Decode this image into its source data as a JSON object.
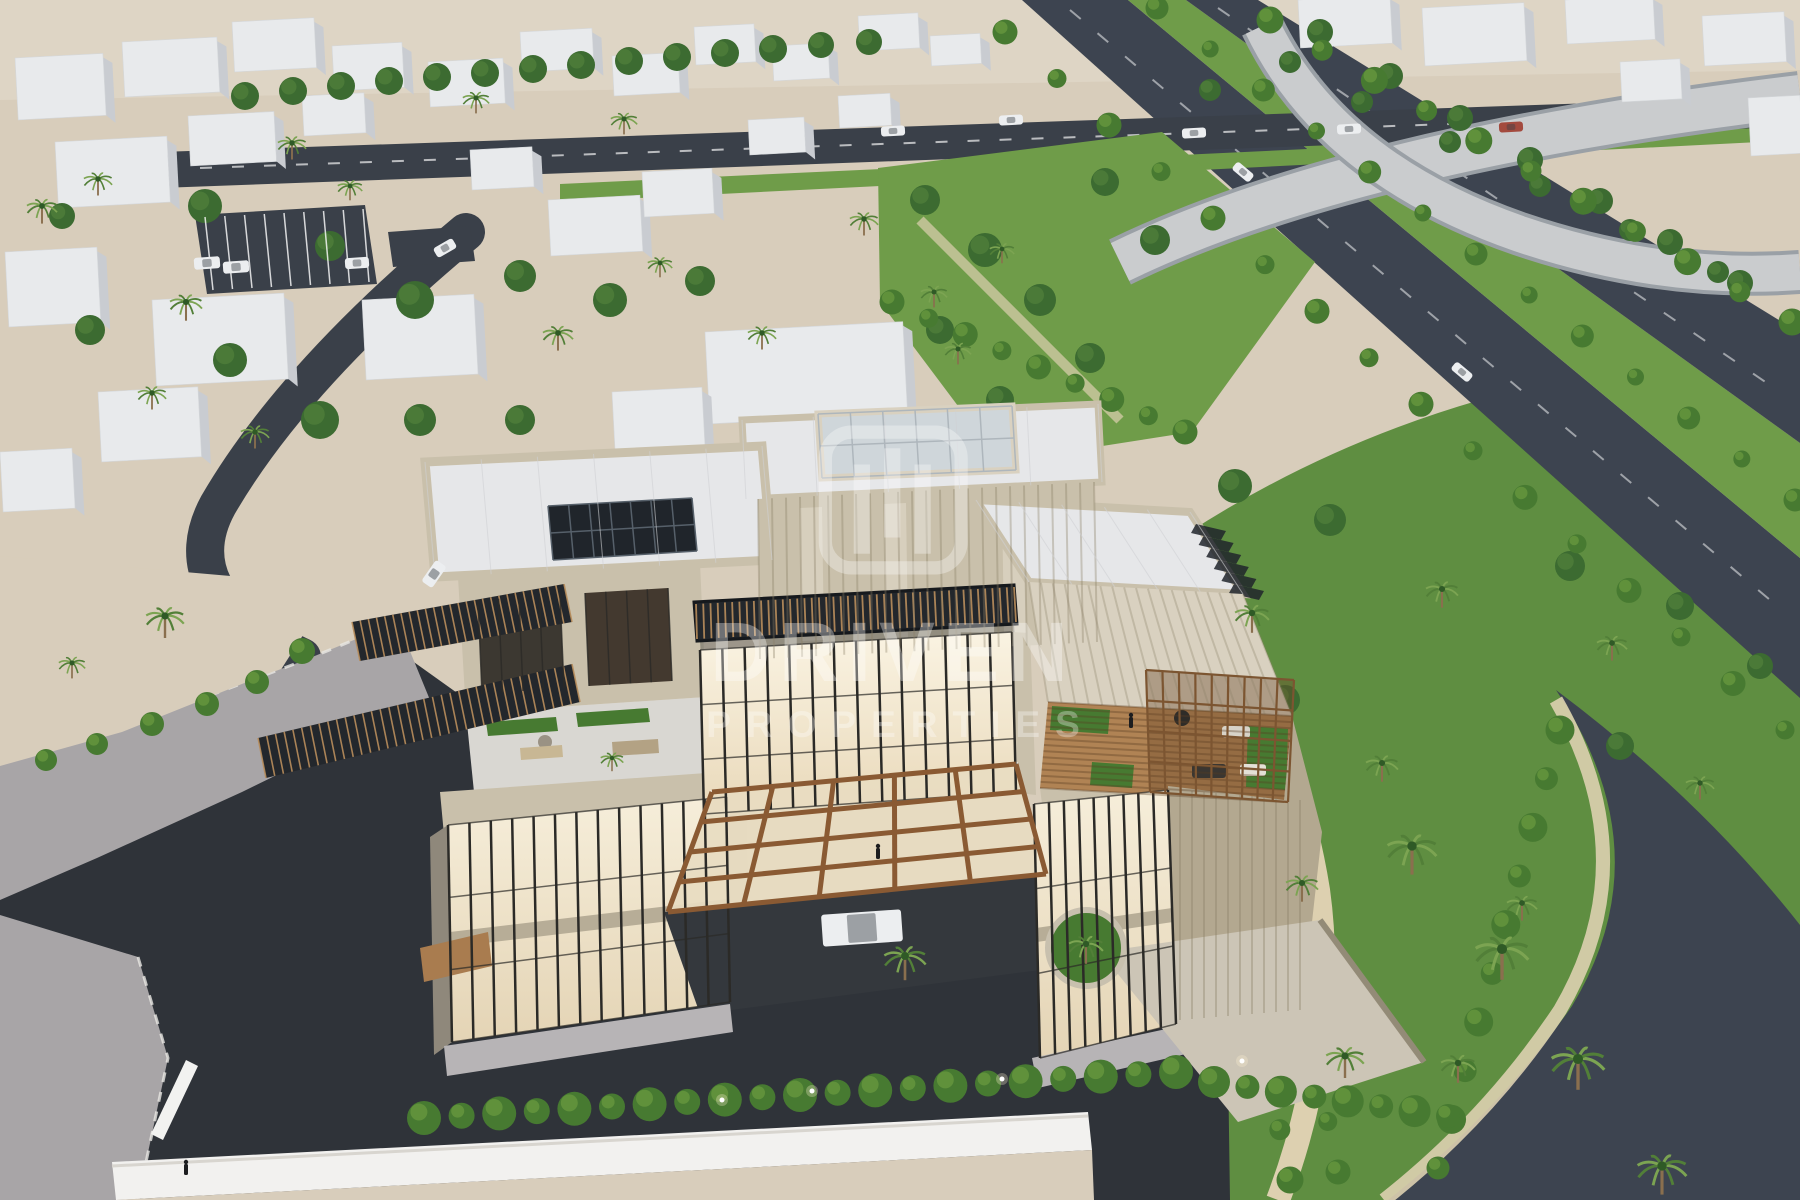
{
  "watermark": {
    "logo_icon": "driven-properties-logo",
    "brand": "DRIVEN",
    "brand_sub": "PROPERTIES",
    "color": "#ffffff",
    "opacity": 0.33
  },
  "palette": {
    "sand": "#d8cdbb",
    "sand2": "#e3dacb",
    "roadDark": "#2f3339",
    "roadMed": "#3a4049",
    "roadFwy": "#3d4450",
    "pave": "#a8a5a7",
    "paveL": "#b7b4b6",
    "lawn": "#5f8e41",
    "lawnL": "#6f9c49",
    "bush": "#477a31",
    "bushL": "#66973f",
    "tree": "#3c6b31",
    "treeL": "#4e7d39",
    "palm": "#527f38",
    "palmL": "#7ca452",
    "trunk": "#8a6f4e",
    "ctx": "#e8eaec",
    "ctxSide": "#c9ccd1",
    "stone": "#c9c0ab",
    "stoneL": "#d9d1c0",
    "stoneD": "#b3a890",
    "streak": "#8a7f66",
    "roof": "#e6e7e9",
    "roofLine": "#d0d1d4",
    "glassWarmA": "#f6eeda",
    "glassWarmB": "#e4d4b5",
    "sky": "#cfd6da",
    "mullion": "#2b2a27",
    "bronze": "#8a5a33",
    "wood": "#a97c4f",
    "deck": "#b08354",
    "louver": "#23272c",
    "slat": "#b98e5c",
    "solar": "#20252b",
    "solarLine": "#56606a",
    "wall": "#f2f1ef",
    "path": "#ddd0b0",
    "flyover": "#caccce",
    "flyoverEdge": "#9aa0a6",
    "carWhite": "#eceef0",
    "carRed": "#a34a3e",
    "figure": "#1c1d1f"
  },
  "scene": {
    "context_buildings": [
      [
        15,
        58,
        88,
        62
      ],
      [
        122,
        42,
        95,
        55
      ],
      [
        232,
        22,
        82,
        50
      ],
      [
        332,
        46,
        70,
        45
      ],
      [
        428,
        62,
        75,
        45
      ],
      [
        520,
        32,
        72,
        40
      ],
      [
        612,
        56,
        66,
        40
      ],
      [
        694,
        27,
        60,
        38
      ],
      [
        772,
        46,
        56,
        35
      ],
      [
        858,
        16,
        60,
        35
      ],
      [
        930,
        36,
        50,
        30
      ],
      [
        55,
        142,
        112,
        66
      ],
      [
        188,
        116,
        86,
        50
      ],
      [
        302,
        96,
        62,
        40
      ],
      [
        470,
        150,
        62,
        40
      ],
      [
        548,
        200,
        92,
        56
      ],
      [
        642,
        172,
        70,
        45
      ],
      [
        748,
        120,
        56,
        35
      ],
      [
        838,
        96,
        52,
        32
      ],
      [
        5,
        252,
        92,
        75
      ],
      [
        152,
        300,
        132,
        86
      ],
      [
        362,
        300,
        112,
        80
      ],
      [
        98,
        392,
        100,
        70
      ],
      [
        0,
        452,
        72,
        60
      ],
      [
        705,
        332,
        198,
        92
      ],
      [
        612,
        392,
        90,
        62
      ],
      [
        1298,
        0,
        92,
        48
      ],
      [
        1422,
        8,
        102,
        58
      ],
      [
        1565,
        0,
        88,
        44
      ],
      [
        1702,
        16,
        82,
        50
      ],
      [
        1748,
        98,
        52,
        58
      ],
      [
        1620,
        62,
        60,
        40
      ]
    ],
    "trees": [
      [
        245,
        96,
        14
      ],
      [
        293,
        91,
        14
      ],
      [
        341,
        86,
        14
      ],
      [
        389,
        81,
        14
      ],
      [
        437,
        77,
        14
      ],
      [
        485,
        73,
        14
      ],
      [
        533,
        69,
        14
      ],
      [
        581,
        65,
        14
      ],
      [
        629,
        61,
        14
      ],
      [
        677,
        57,
        14
      ],
      [
        725,
        53,
        14
      ],
      [
        773,
        49,
        14
      ],
      [
        821,
        45,
        13
      ],
      [
        869,
        42,
        13
      ],
      [
        205,
        206,
        17
      ],
      [
        330,
        246,
        15
      ],
      [
        415,
        300,
        19
      ],
      [
        520,
        276,
        16
      ],
      [
        610,
        300,
        17
      ],
      [
        700,
        281,
        15
      ],
      [
        230,
        360,
        17
      ],
      [
        320,
        420,
        19
      ],
      [
        420,
        420,
        16
      ],
      [
        520,
        420,
        15
      ],
      [
        90,
        330,
        15
      ],
      [
        62,
        216,
        13
      ],
      [
        925,
        200,
        15
      ],
      [
        985,
        250,
        17
      ],
      [
        1040,
        300,
        16
      ],
      [
        1090,
        358,
        15
      ],
      [
        1000,
        400,
        14
      ],
      [
        940,
        330,
        14
      ],
      [
        1105,
        182,
        14
      ],
      [
        1155,
        240,
        15
      ],
      [
        1235,
        486,
        17
      ],
      [
        1330,
        520,
        16
      ],
      [
        1570,
        566,
        15
      ],
      [
        1680,
        606,
        14
      ],
      [
        1760,
        666,
        13
      ],
      [
        1285,
        700,
        15
      ],
      [
        1620,
        746,
        14
      ],
      [
        1210,
        90,
        11
      ],
      [
        1290,
        62,
        11
      ],
      [
        1362,
        102,
        11
      ],
      [
        1450,
        142,
        11
      ],
      [
        1540,
        186,
        11
      ],
      [
        1630,
        230,
        11
      ],
      [
        1718,
        272,
        11
      ],
      [
        1320,
        32,
        13
      ],
      [
        1390,
        76,
        13
      ],
      [
        1460,
        118,
        13
      ],
      [
        1530,
        160,
        13
      ],
      [
        1600,
        201,
        13
      ],
      [
        1670,
        242,
        13
      ],
      [
        1740,
        283,
        13
      ]
    ],
    "palms": [
      [
        42,
        206,
        16
      ],
      [
        98,
        179,
        15
      ],
      [
        186,
        302,
        17
      ],
      [
        292,
        143,
        15
      ],
      [
        476,
        98,
        14
      ],
      [
        558,
        333,
        16
      ],
      [
        624,
        119,
        14
      ],
      [
        762,
        333,
        15
      ],
      [
        864,
        219,
        15
      ],
      [
        934,
        292,
        14
      ],
      [
        958,
        349,
        14
      ],
      [
        1002,
        249,
        13
      ],
      [
        152,
        393,
        15
      ],
      [
        255,
        432,
        15
      ],
      [
        350,
        186,
        13
      ],
      [
        660,
        263,
        13
      ],
      [
        165,
        616,
        20
      ],
      [
        72,
        663,
        14
      ],
      [
        1252,
        613,
        18
      ],
      [
        1442,
        589,
        17
      ],
      [
        1612,
        643,
        16
      ],
      [
        1382,
        763,
        17
      ],
      [
        1700,
        783,
        15
      ],
      [
        1302,
        883,
        17
      ],
      [
        1522,
        903,
        16
      ],
      [
        1458,
        1063,
        18
      ],
      [
        1412,
        846,
        26
      ],
      [
        1502,
        949,
        28
      ],
      [
        1578,
        1059,
        28
      ],
      [
        1662,
        1166,
        26
      ],
      [
        1345,
        1056,
        20
      ],
      [
        905,
        956,
        22
      ],
      [
        1086,
        944,
        18
      ],
      [
        612,
        758,
        12
      ]
    ],
    "bushes": [
      [
        302,
        651,
        13
      ],
      [
        257,
        682,
        12
      ],
      [
        207,
        704,
        12
      ],
      [
        152,
        724,
        12
      ],
      [
        97,
        744,
        11
      ],
      [
        46,
        760,
        11
      ],
      [
        480,
        641,
        10
      ],
      [
        521,
        633,
        9
      ],
      [
        1080,
        980,
        12
      ],
      [
        1110,
        965,
        10
      ]
    ],
    "bush_rows": [
      [
        1005,
        32,
        1785,
        730,
        15,
        11
      ],
      [
        1157,
        8,
        1795,
        500,
        12,
        10
      ],
      [
        1560,
        730,
        1438,
        1168,
        9,
        13
      ],
      [
        1168,
        576,
        1290,
        1180,
        12,
        12
      ],
      [
        1215,
        566,
        1338,
        1172,
        12,
        11
      ],
      [
        892,
        302,
        1185,
        432,
        8,
        11
      ],
      [
        1270,
        20,
        1792,
        322,
        10,
        12
      ]
    ],
    "hedge_rows": [
      [
        424,
        1118,
        1176,
        1072,
        20,
        15
      ],
      [
        1214,
        1082,
        1448,
        1116,
        7,
        14
      ]
    ],
    "cars": [
      [
        207,
        263,
        26,
        12,
        -4,
        "w"
      ],
      [
        236,
        267,
        26,
        12,
        -4,
        "w"
      ],
      [
        357,
        263,
        24,
        11,
        -4,
        "w"
      ],
      [
        445,
        248,
        22,
        11,
        -30,
        "w"
      ],
      [
        434,
        574,
        26,
        13,
        -55,
        "w"
      ],
      [
        893,
        131,
        24,
        10,
        -3,
        "w"
      ],
      [
        1011,
        120,
        24,
        10,
        -3,
        "w"
      ],
      [
        1194,
        133,
        24,
        10,
        -3,
        "w"
      ],
      [
        1349,
        129,
        24,
        10,
        -3,
        "w"
      ],
      [
        1511,
        127,
        24,
        10,
        -3,
        "r"
      ],
      [
        1243,
        172,
        22,
        10,
        40,
        "w"
      ],
      [
        1462,
        372,
        22,
        10,
        40,
        "w"
      ],
      [
        862,
        928,
        80,
        32,
        -4,
        "w"
      ]
    ],
    "lights": [
      [
        722,
        1100
      ],
      [
        812,
        1091
      ],
      [
        1002,
        1079
      ],
      [
        1242,
        1061
      ]
    ],
    "figures": [
      [
        1131,
        727
      ],
      [
        878,
        858
      ],
      [
        186,
        1174
      ]
    ]
  }
}
